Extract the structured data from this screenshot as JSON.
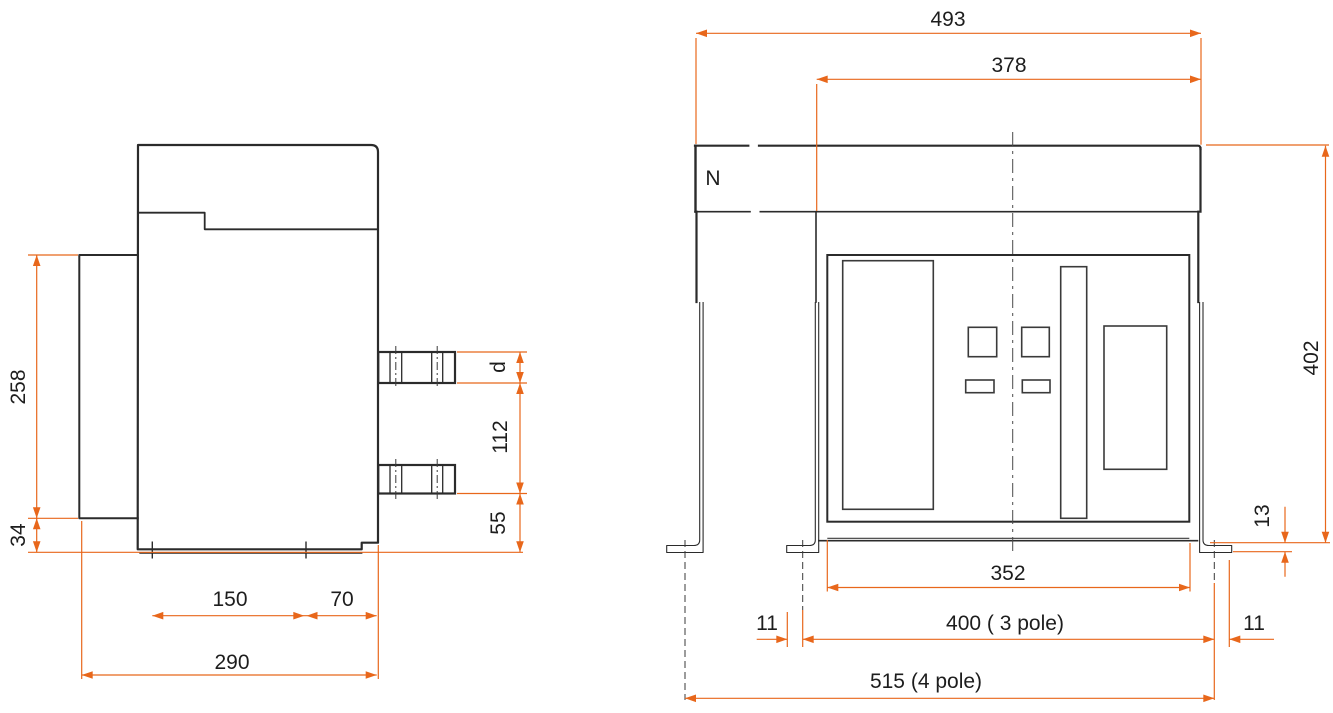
{
  "drawing": {
    "type": "circuit-breaker outline and mounting dimension drawing",
    "units": "mm",
    "colors": {
      "dimension_orange": "#e8671b",
      "line_dark": "#2b2b2b",
      "text": "#1d1d1d"
    }
  },
  "side_view": {
    "flange_height": "258",
    "flange_to_base": "34",
    "mount_depth_front": "150",
    "mount_depth_rear": "70",
    "overall_depth": "290",
    "terminal_thickness": "d",
    "terminal_pitch": "112",
    "terminal_to_base": "55"
  },
  "front_view": {
    "overall_width": "493",
    "body_width": "378",
    "neutral_pole": "N",
    "overall_height": "402",
    "foot_plate_height": "13",
    "face_width": "352",
    "foot_edge_left": "11",
    "width_3pole": "400 ( 3 pole)",
    "foot_edge_right": "11",
    "width_4pole": "515 (4 pole)"
  }
}
